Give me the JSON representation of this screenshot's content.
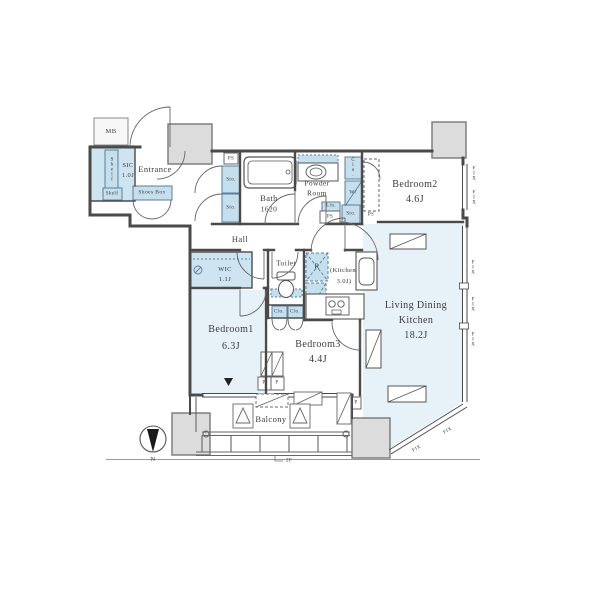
{
  "rooms": {
    "entrance": "Entrance",
    "sic": "SIC",
    "sic_size": "1.0J",
    "hall": "Hall",
    "bath": "Bath",
    "bath_size": "1620",
    "powder1": "Powder",
    "powder2": "Room",
    "bedroom1": "Bedroom1",
    "bedroom1_size": "6.3J",
    "bedroom2": "Bedroom2",
    "bedroom2_size": "4.6J",
    "bedroom3": "Bedroom3",
    "bedroom3_size": "4.4J",
    "ldk1": "Living Dining",
    "ldk2": "Kitchen",
    "ldk_size": "18.2J",
    "kitchen1": "(Kitchen",
    "kitchen2": "3.0J)",
    "wic": "WIC",
    "wic_size": "1.1J",
    "toilet": "Toilet",
    "balcony": "Balcony"
  },
  "storage": {
    "mb": "MB",
    "shelf_tall": "Shelf",
    "shelf_small": "Shelf",
    "shoes_box": "Shoes Box",
    "sto_hall_top": "Sto.",
    "sto_hall_bottom": "Sto.",
    "sto_powder": "Sto.",
    "lin": "Lin.",
    "clo_bedroom2": "Clo.",
    "washer": "W/",
    "clo_left": "Clo.",
    "clo_right": "Clo.",
    "fridge": "R"
  },
  "service": {
    "ps_top": "PS",
    "ps_powder": "PS",
    "ps_bedroom2": "PS",
    "p_left": "P",
    "p_right": "P",
    "p_balcony": "P"
  },
  "windows": {
    "fix": "FIX"
  },
  "compass": {
    "north": "N"
  },
  "floor": {
    "mark": "2F"
  },
  "colors": {
    "wall": "#4a4a4a",
    "room_fill": "#e7f1f8",
    "closet_fill": "#c6dfee",
    "pillar_fill": "#dcdcdc",
    "text": "#3b3b3b"
  }
}
